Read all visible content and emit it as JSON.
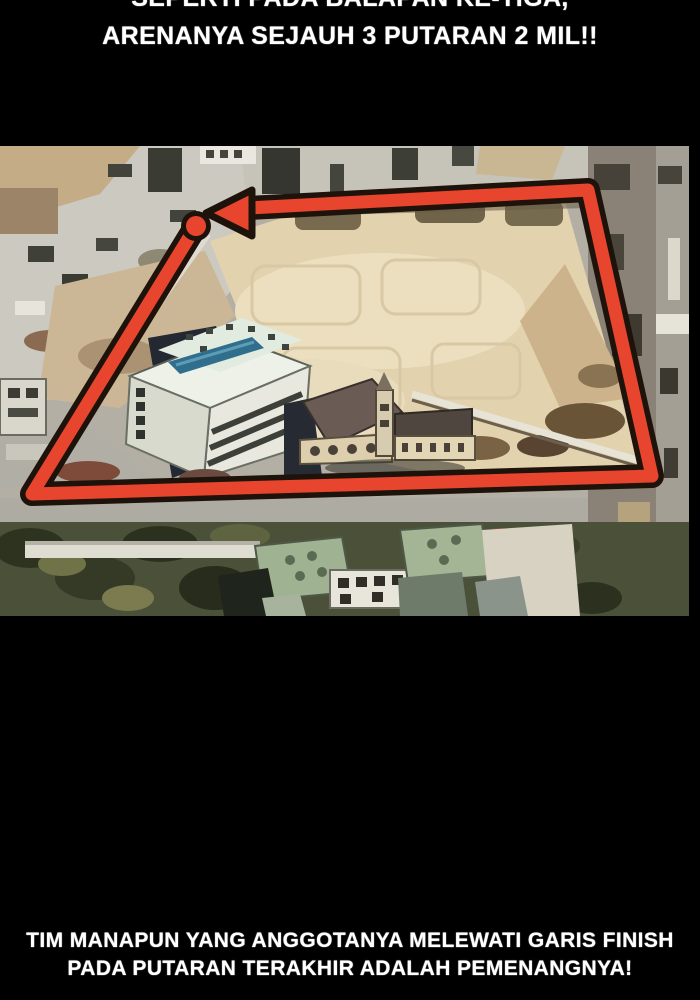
{
  "page": {
    "background": "#000000",
    "text_color": "#ffffff"
  },
  "top_caption": {
    "line1": "SEPERTI PADA BALAPAN KE-TIGA,",
    "line2": "ARENANYA SEJAUH 3 PUTARAN 2 MIL!!"
  },
  "bottom_caption": {
    "line1": "TIM MANAPUN YANG ANGGOTANYA MELEWATI GARIS FINISH",
    "line2": "PADA PUTARAN TERAKHIR ADALAH PEMENANGNYA!"
  },
  "panel": {
    "description": "stylized aerial photo of a race arena: dirt construction field, white office building with rooftop pool, church with spire, tree-lined streets, with a red race route loop drawn over it ending in a left-pointing arrow and a start dot",
    "route_color": "#e8452e",
    "route_outline": "#1d130b"
  }
}
